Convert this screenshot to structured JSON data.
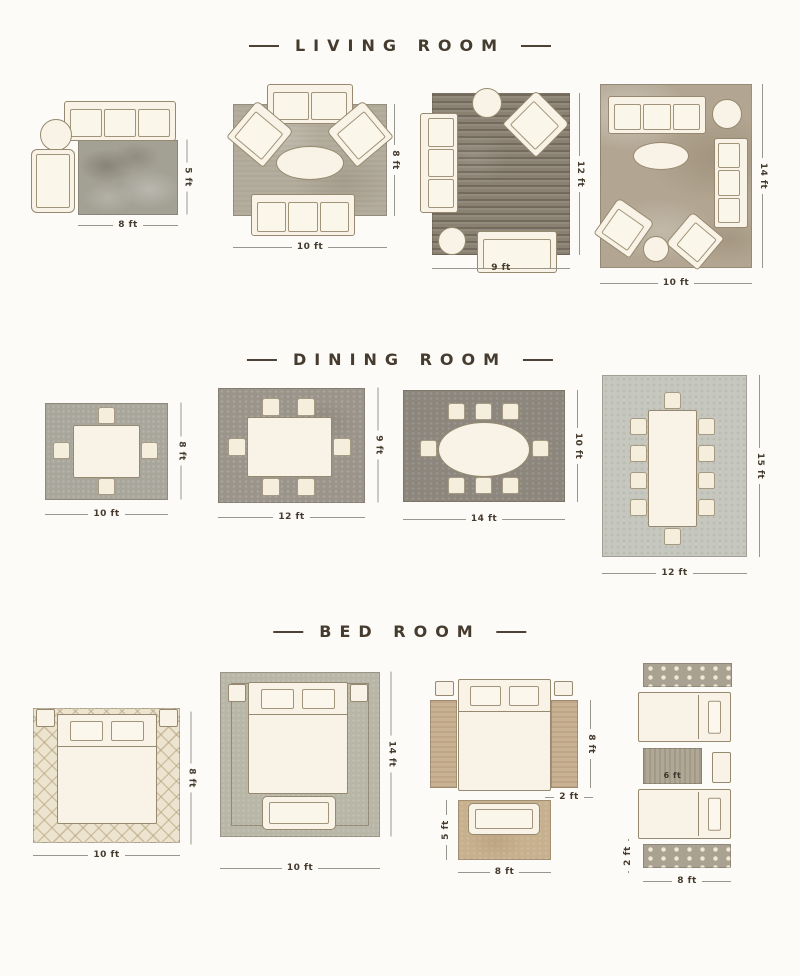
{
  "sections": {
    "living": {
      "title": "LIVING ROOM"
    },
    "dining": {
      "title": "DINING ROOM"
    },
    "bedroom": {
      "title": "BED ROOM"
    }
  },
  "living": {
    "d1": {
      "w": "8 ft",
      "h": "5 ft"
    },
    "d2": {
      "w": "10 ft",
      "h": "8 ft"
    },
    "d3": {
      "w": "9 ft",
      "h": "12 ft"
    },
    "d4": {
      "w": "10 ft",
      "h": "14 ft"
    }
  },
  "dining": {
    "d1": {
      "w": "10 ft",
      "h": "8 ft"
    },
    "d2": {
      "w": "12 ft",
      "h": "9 ft"
    },
    "d3": {
      "w": "14 ft",
      "h": "10 ft"
    },
    "d4": {
      "w": "12 ft",
      "h": "15 ft"
    }
  },
  "bedroom": {
    "d1": {
      "w": "10 ft",
      "h": "8 ft"
    },
    "d2": {
      "w": "10 ft",
      "h": "14 ft"
    },
    "d3": {
      "runner_h": "8 ft",
      "runner_w": "2 ft",
      "foot_h": "5 ft",
      "foot_w": "8 ft"
    },
    "d4": {
      "mid_rug": "6 ft",
      "runner_w": "2 ft",
      "w": "8 ft"
    }
  },
  "colors": {
    "title": "#453b2f",
    "dimension_line": "#98978f",
    "furniture": "#f8f3e6"
  }
}
